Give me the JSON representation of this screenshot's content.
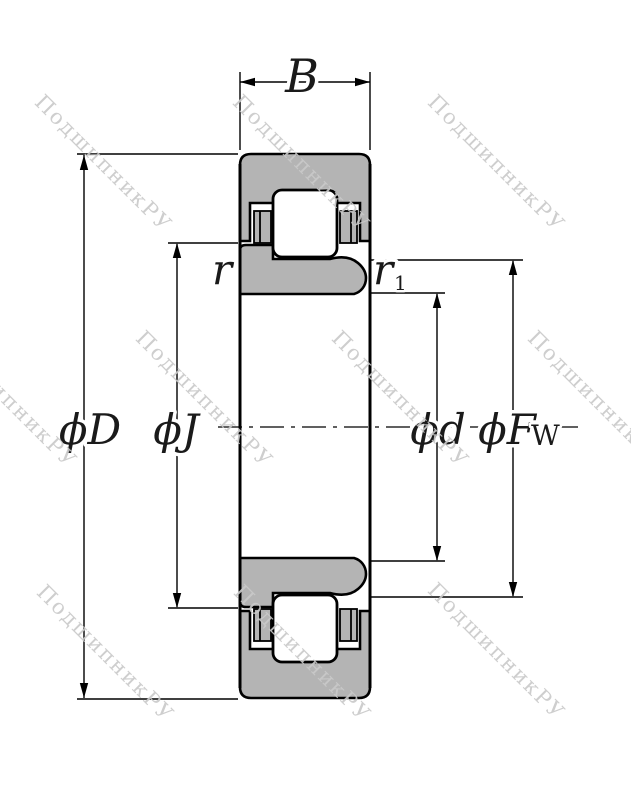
{
  "diagram": {
    "kind": "cylindrical-roller-bearing-cross-section",
    "colors": {
      "ring_fill": "#b4b4b4",
      "line": "#000000",
      "watermark": "#c9c9c9",
      "background": "#ffffff"
    }
  },
  "dimensions": {
    "width": {
      "label": "B"
    },
    "outer_diameter": {
      "label": "ϕD"
    },
    "rib_diameter": {
      "label": "ϕJ"
    },
    "bore_diameter": {
      "label": "ϕd"
    },
    "raceway_diameter": {
      "label_main": "ϕF",
      "label_sub": "W"
    },
    "chamfer_outer": {
      "label": "r"
    },
    "chamfer_inner": {
      "label_main": "r",
      "label_sub": "1"
    }
  },
  "watermark": {
    "text": "ПодшипникРУ"
  }
}
